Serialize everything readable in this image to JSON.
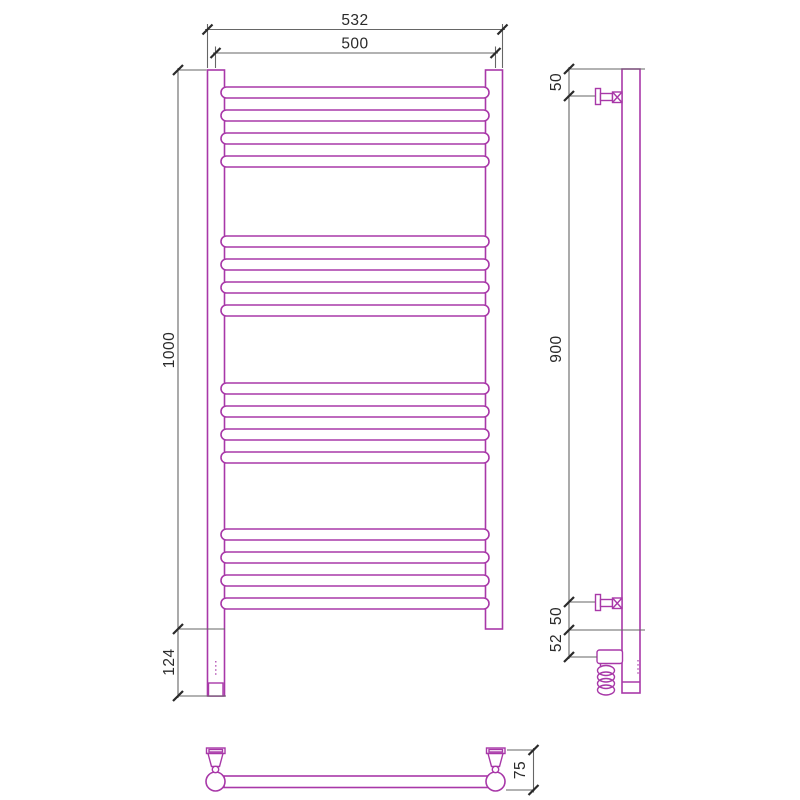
{
  "drawing": {
    "kind": "heated towel rail dimensional drawing",
    "views": {
      "front": {
        "name": "front-view",
        "rung_count": 16,
        "rung_groups": 4,
        "dims": {
          "outer_width": "532",
          "center_width": "500",
          "height": "1000",
          "bottom_extension": "124"
        }
      },
      "side": {
        "name": "side-view",
        "dims": {
          "top_bracket_offset": "50",
          "bracket_span": "900",
          "bottom_bracket_offset": "50",
          "element_offset": "52"
        }
      },
      "bottom": {
        "name": "bottom-view",
        "dims": {
          "depth": "75"
        }
      }
    },
    "colors": {
      "product": "#A838A8",
      "dimension": "#666666",
      "label": "#2A2A2A",
      "bg": "#FFFFFF"
    }
  }
}
